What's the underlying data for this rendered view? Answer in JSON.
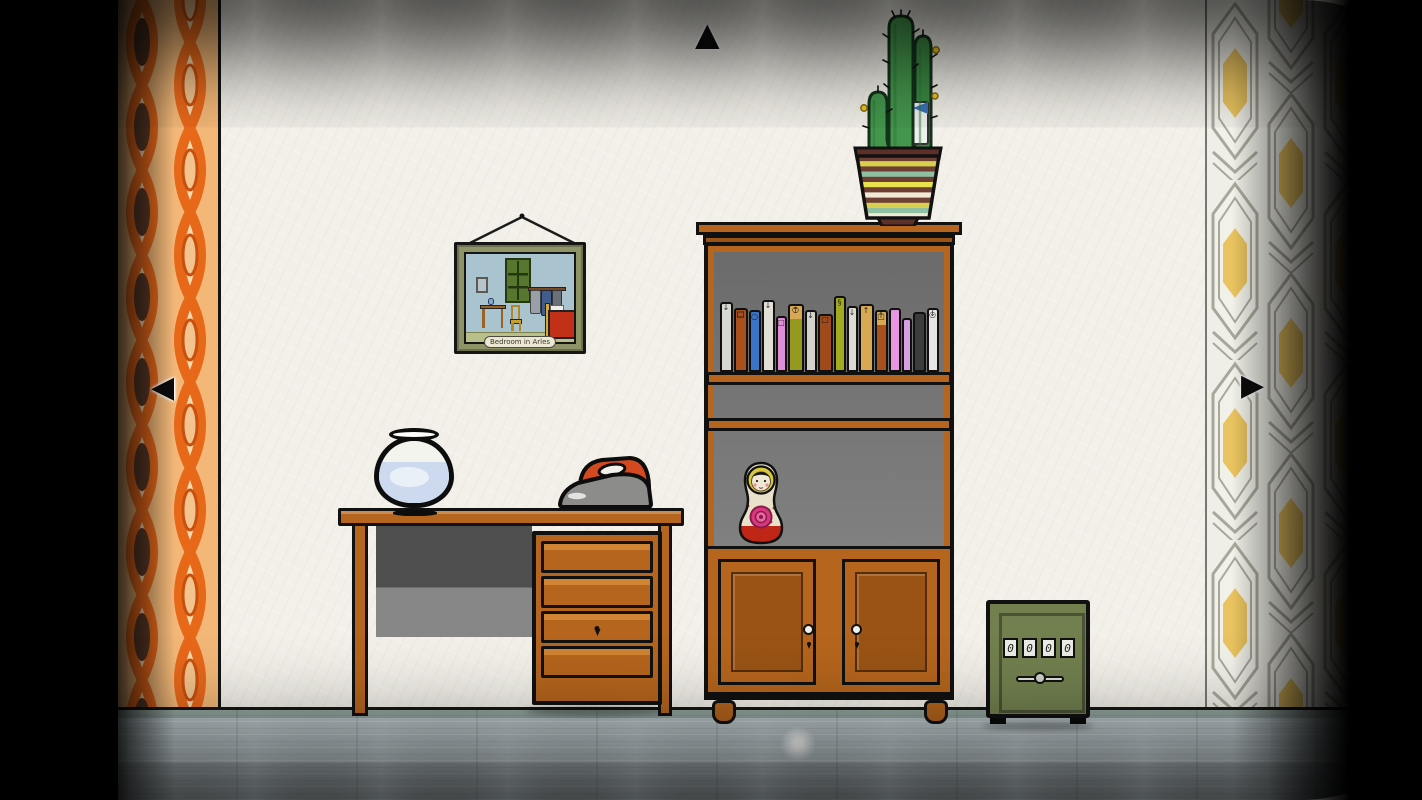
{
  "scene": {
    "name": "retro-room-with-bookshelf"
  },
  "nav": {
    "up": "▲",
    "left": "◀",
    "right": "▶"
  },
  "picture": {
    "caption": "Bedroom in Arles"
  },
  "safe": {
    "dials": [
      "0",
      "0",
      "0",
      "0"
    ]
  },
  "bookshelf": {
    "books": [
      {
        "color": "#d8d8d2",
        "width": 13,
        "height": 70,
        "top": "",
        "bottom": "↓"
      },
      {
        "color": "#a8511c",
        "width": 14,
        "height": 64,
        "top": "□",
        "bottom": "□"
      },
      {
        "color": "#3a74c8",
        "width": 12,
        "height": 62,
        "top": "○",
        "bottom": ""
      },
      {
        "color": "#e2e0d6",
        "width": 13,
        "height": 72,
        "top": "",
        "bottom": "↓"
      },
      {
        "color": "#df8ed8",
        "width": 11,
        "height": 56,
        "top": "□",
        "bottom": ""
      },
      {
        "color": "#96991f",
        "width": 16,
        "height": 68,
        "cap": "#d8a855",
        "top": "↑",
        "bottom": "○"
      },
      {
        "color": "#d4d2ca",
        "width": 12,
        "height": 62,
        "top": "",
        "bottom": "↓"
      },
      {
        "color": "#9e4a1a",
        "width": 15,
        "height": 58,
        "top": "",
        "bottom": "□"
      },
      {
        "color": "#a2aa1e",
        "width": 12,
        "height": 76,
        "top": "§",
        "bottom": ""
      },
      {
        "color": "#dcdad2",
        "width": 11,
        "height": 66,
        "top": "↓",
        "bottom": ""
      },
      {
        "color": "#d9a853",
        "width": 15,
        "height": 68,
        "top": "↑",
        "bottom": ""
      },
      {
        "color": "#a8511c",
        "width": 13,
        "height": 62,
        "cap": "#d8a855",
        "top": "□",
        "bottom": "↑"
      },
      {
        "color": "#e895e2",
        "width": 12,
        "height": 64,
        "top": "",
        "bottom": ""
      },
      {
        "color": "#d8a0e0",
        "width": 10,
        "height": 54,
        "top": "",
        "bottom": ""
      },
      {
        "color": "#3c3c3c",
        "width": 13,
        "height": 60,
        "top": "",
        "bottom": ""
      },
      {
        "color": "#e6e6e2",
        "width": 12,
        "height": 64,
        "top": "○",
        "bottom": "↓"
      }
    ]
  },
  "pot": {
    "stripes": [
      "#6e4034",
      "#d8cf4e",
      "#6e4034",
      "#8fc0a2",
      "#6e4034",
      "#e8e24e",
      "#6e4034",
      "#efe9d6",
      "#6e4034",
      "#d8cf4e",
      "#8fc0a2",
      "#efe9d6"
    ]
  },
  "colors": {
    "wood": "#b5651d",
    "wood_dark": "#9a5315",
    "wood_light": "#d08434",
    "wall": "#f2f0e8",
    "floor": "#b7c3c7",
    "safe_green": "#72804f",
    "wallpaper_orange": "#e8681a",
    "wallpaper_cream": "#f7d9ac",
    "wallpaper_brown": "#5a3a28",
    "wallpaper_yellow": "#e9c35f",
    "cactus_green": "#44964c",
    "iron_red": "#d4491f"
  }
}
